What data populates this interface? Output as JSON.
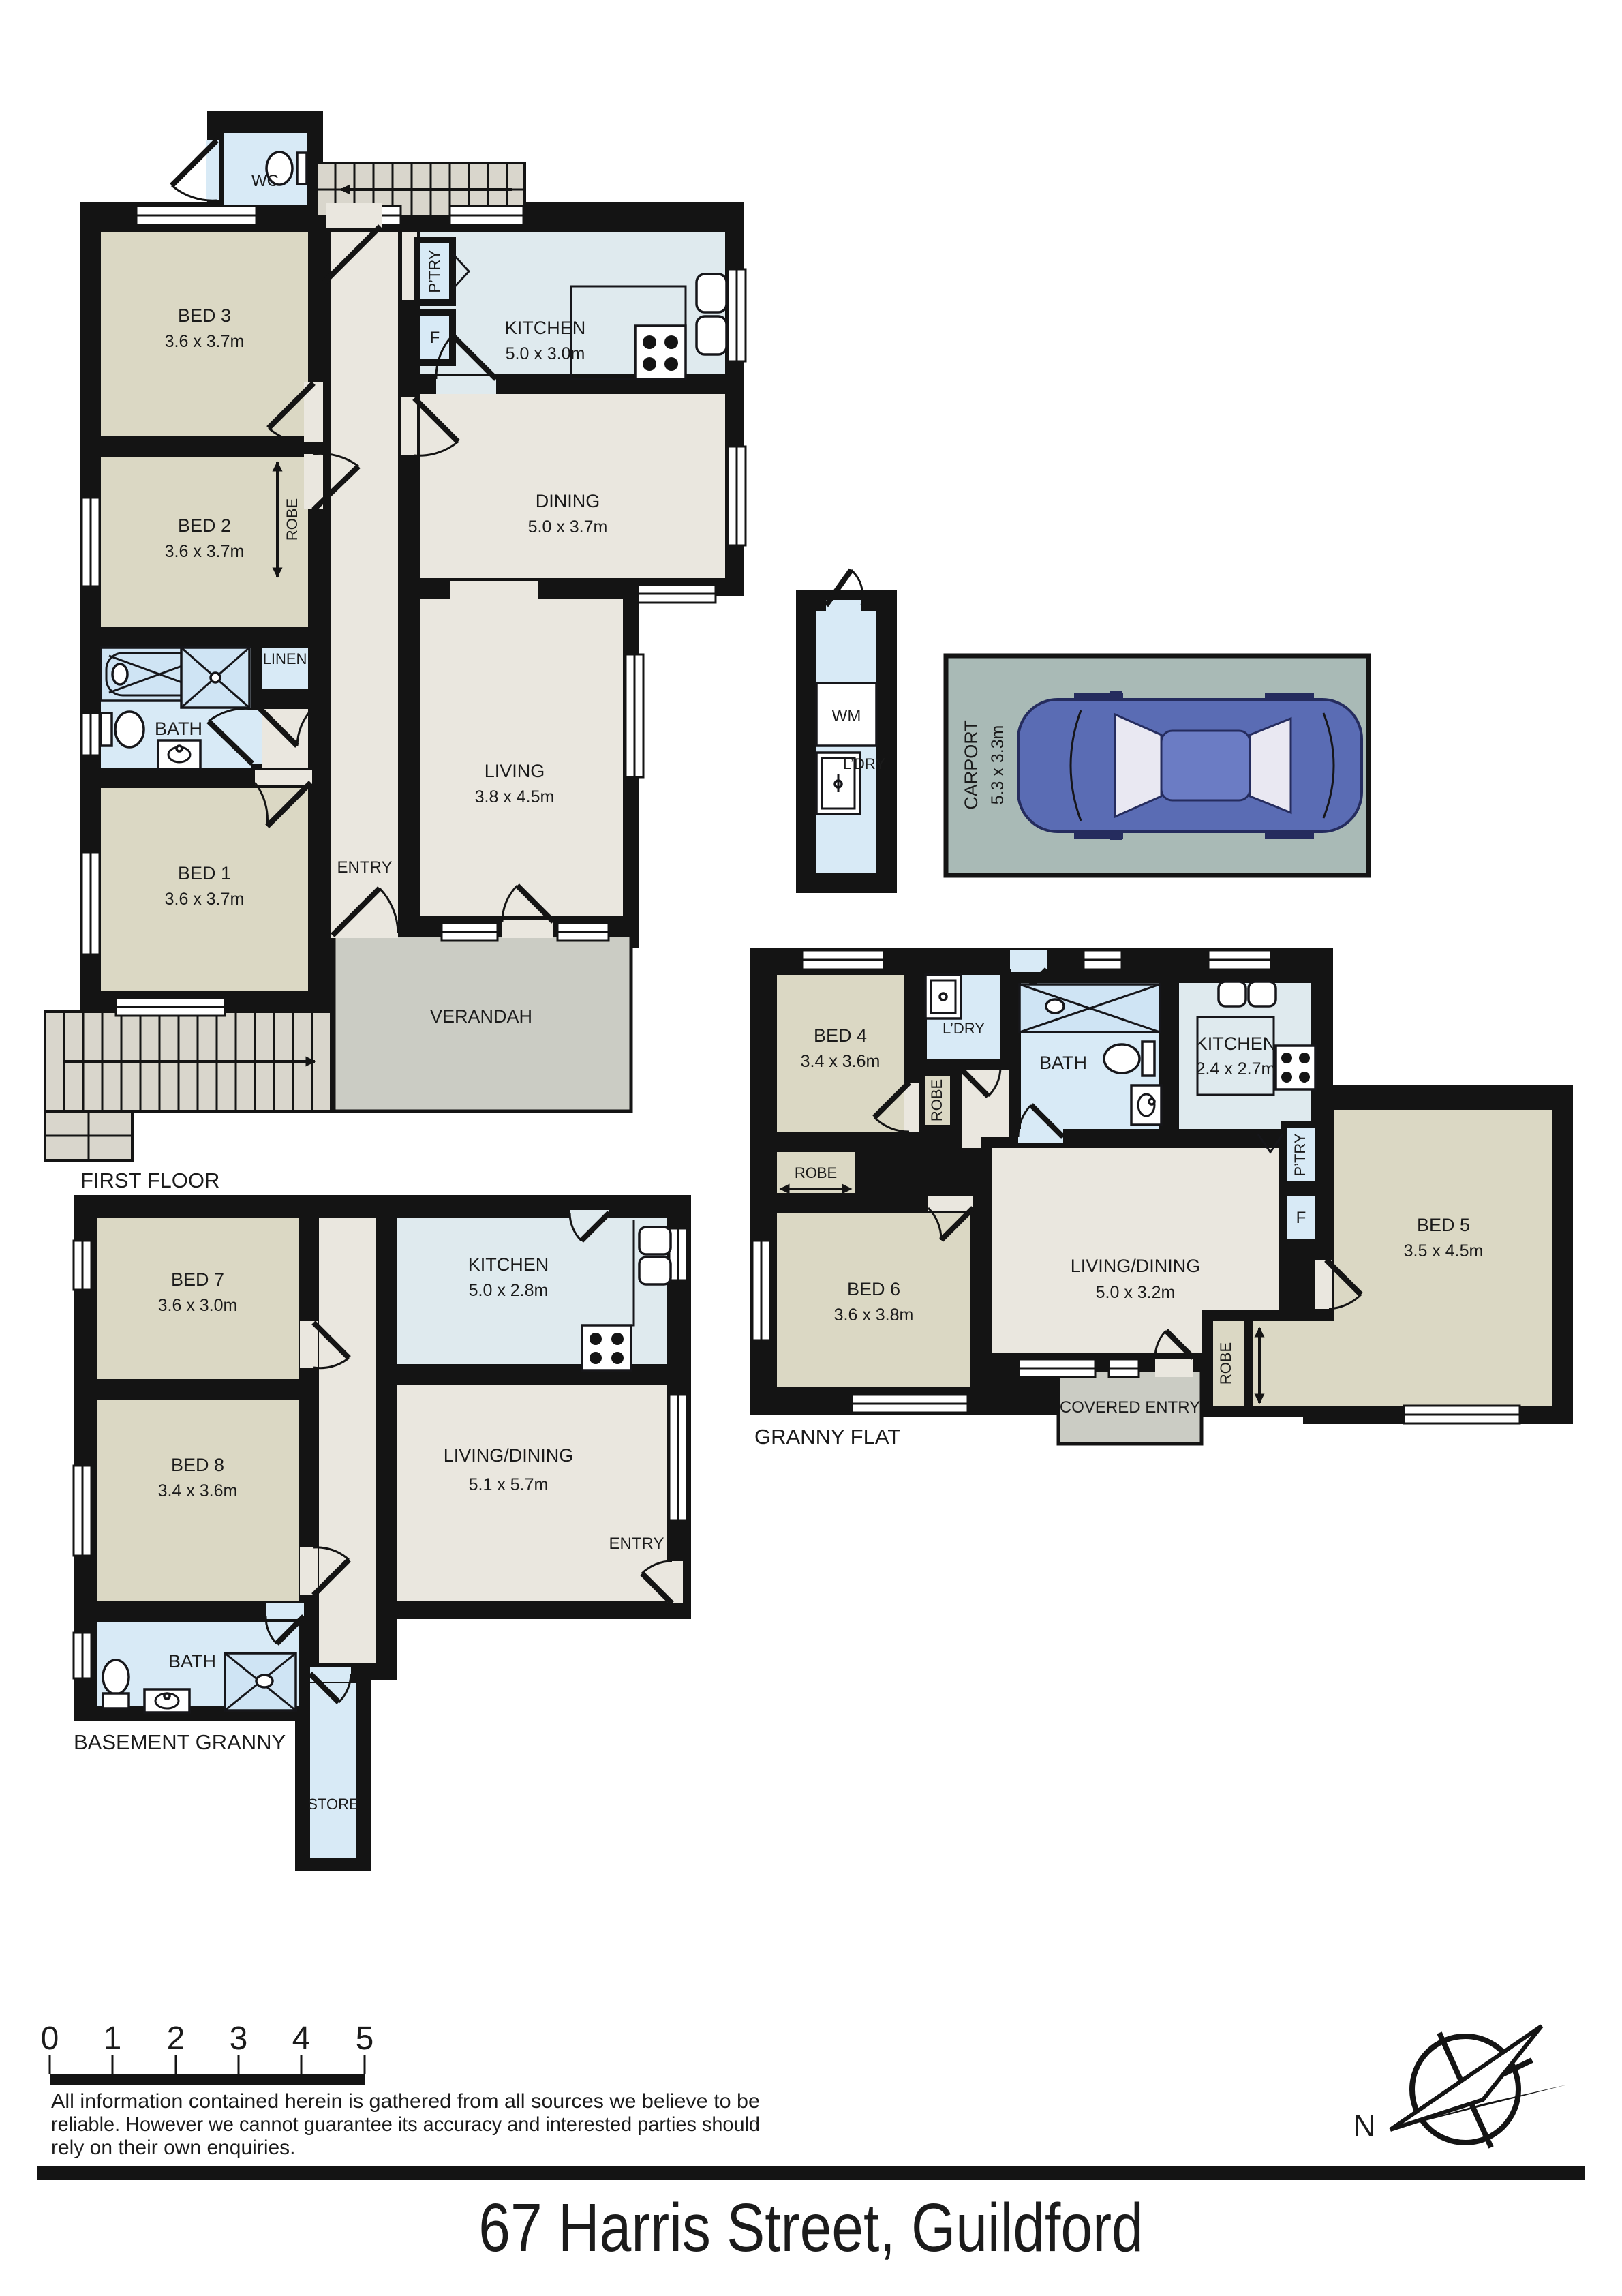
{
  "title": "67 Harris Street, Guildford",
  "colors": {
    "wall": "#141414",
    "bedroom_fill": "#DBD8C4",
    "living_fill": "#EAE7DF",
    "kitchen_fill": "#DFEAEE",
    "bathroom_fill": "#D8EAF6",
    "verandah_fill": "#CBCCC4",
    "carport_fill": "#A9BAB6",
    "car_body": "#5A6CB4"
  },
  "first_floor": {
    "floor_label": "FIRST FLOOR",
    "wc_label": "WC",
    "bed3_name": "BED 3",
    "bed3_dims": "3.6 x 3.7m",
    "bed2_name": "BED 2",
    "bed2_dims": "3.6 x 3.7m",
    "robe_label": "ROBE",
    "linen_label": "LINEN",
    "bath_label": "BATH",
    "bed1_name": "BED 1",
    "bed1_dims": "3.6 x 3.7m",
    "entry_label": "ENTRY",
    "kitchen_name": "KITCHEN",
    "kitchen_dims": "5.0 x 3.0m",
    "pantry_label": "P’TRY",
    "fridge_label": "F",
    "dining_name": "DINING",
    "dining_dims": "5.0 x 3.7m",
    "living_name": "LIVING",
    "living_dims": "3.8 x 4.5m",
    "verandah_label": "VERANDAH"
  },
  "laundry": {
    "wm_label": "WM",
    "name": "L’DRY"
  },
  "carport": {
    "name": "CARPORT",
    "dims": "5.3 x 3.3m"
  },
  "granny_flat": {
    "floor_label": "GRANNY FLAT",
    "bed4_name": "BED 4",
    "bed4_dims": "3.4 x 3.6m",
    "ldry_label": "L’DRY",
    "bath_label": "BATH",
    "kitchen_name": "KITCHEN",
    "kitchen_dims": "2.4 x 2.7m",
    "robe_bed4_label": "ROBE",
    "robe_bed6_label": "ROBE",
    "robe_bed5_label": "ROBE",
    "pantry_label": "P’TRY",
    "fridge_label": "F",
    "bed6_name": "BED 6",
    "bed6_dims": "3.6 x 3.8m",
    "living_name": "LIVING/DINING",
    "living_dims": "5.0 x 3.2m",
    "bed5_name": "BED 5",
    "bed5_dims": "3.5 x 4.5m",
    "covered_entry_label": "COVERED ENTRY"
  },
  "basement": {
    "floor_label": "BASEMENT GRANNY",
    "bed7_name": "BED 7",
    "bed7_dims": "3.6 x 3.0m",
    "bed8_name": "BED 8",
    "bed8_dims": "3.4 x 3.6m",
    "kitchen_name": "KITCHEN",
    "kitchen_dims": "5.0 x 2.8m",
    "living_name": "LIVING/DINING",
    "living_dims": "5.1 x 5.7m",
    "entry_label": "ENTRY",
    "bath_label": "BATH",
    "store_label": "STORE"
  },
  "footer": {
    "scale_ticks": [
      "0",
      "1",
      "2",
      "3",
      "4",
      "5"
    ],
    "disclaimer_line1": "All information contained herein is gathered from all sources we believe to be",
    "disclaimer_line2": "reliable. However we cannot guarantee its accuracy and interested parties should",
    "disclaimer_line3": "rely on their own enquiries.",
    "compass_label": "N"
  }
}
